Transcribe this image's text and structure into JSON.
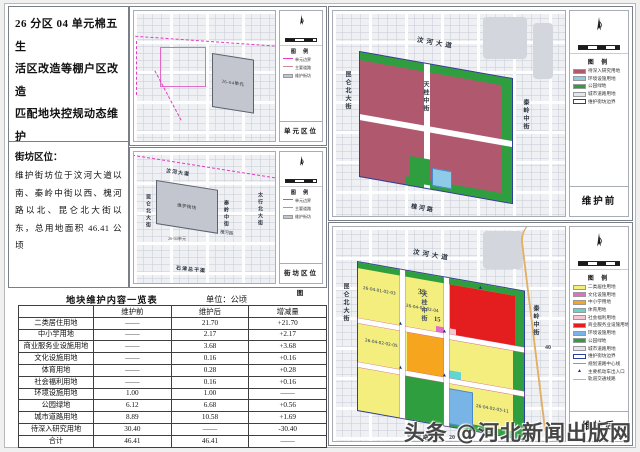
{
  "title_lines": [
    "26 分区 04 单元棉五生",
    "活区改造等棚户区改造",
    "匹配地块控规动态维护",
    "方案"
  ],
  "location": {
    "heading": "街坊区位：",
    "body": "维护街坊位于汶河大道以南、秦岭中街以西、槐河路以北、昆仑北大街以东，总用地面积 46.41 公顷"
  },
  "colors": {
    "residential": "#f3ee7e",
    "commercial": "#e41e1e",
    "school": "#f5a61e",
    "culture": "#e26cc8",
    "sports": "#62d4d4",
    "welfare": "#f5c6d6",
    "environment": "#79b4e6",
    "envlight": "#8ecbe8",
    "park": "#2f9e3f",
    "road": "#e4e6ea",
    "study": "#b0596e",
    "boundary": "#2b3f9e",
    "unitdash": "#e23cc0"
  },
  "unit_map": {
    "caption": "单元区位图",
    "legend_title": "图 例",
    "legend": [
      {
        "type": "dash",
        "color": "#e23cc0",
        "label": "单元边界"
      },
      {
        "type": "line",
        "color": "#d08890",
        "label": "主要道路"
      },
      {
        "type": "fill",
        "color": "#c3c6cf",
        "label": "维护街坊"
      }
    ],
    "block_label": "26-04单元"
  },
  "block_map": {
    "caption": "街坊区位图",
    "legend_title": "图 例",
    "legend": [
      {
        "type": "dash",
        "color": "#e23cc0",
        "label": "单元边界"
      },
      {
        "type": "line",
        "color": "#d08890",
        "label": "主要道路"
      },
      {
        "type": "fill",
        "color": "#c3c6cf",
        "label": "维护街坊"
      }
    ],
    "block_label": "维护街坊",
    "unit_note": "26-04单元",
    "roads": {
      "top": "汶河大道",
      "left": "昆仑北大街",
      "center": "秦岭中街",
      "right": "太行北大街",
      "bottom": "石津总干渠",
      "near": "槐河路"
    }
  },
  "before_map": {
    "caption": "维护前",
    "legend_title": "图 例",
    "legend": [
      {
        "type": "fill",
        "color": "#b0596e",
        "label": "待深入研究用地"
      },
      {
        "type": "fill",
        "color": "#8ecbe8",
        "label": "环境设施用地"
      },
      {
        "type": "fill",
        "color": "#2f9e3f",
        "label": "公园绿地"
      },
      {
        "type": "fill",
        "color": "#e4e6ea",
        "label": "城市道路用地"
      },
      {
        "type": "outline",
        "color": "#2b3f9e",
        "label": "维护街坊边界"
      }
    ],
    "roads": {
      "top": "汶河大道",
      "left": "昆仑北大街",
      "center": "天桂中街",
      "right": "秦岭中街",
      "bottom": "槐河路"
    }
  },
  "after_map": {
    "caption": "维护后",
    "legend_title": "图 例",
    "legend": [
      {
        "type": "fill",
        "color": "#f3ee7e",
        "label": "二类居住用地"
      },
      {
        "type": "fill",
        "color": "#e26cc8",
        "label": "文化设施用地"
      },
      {
        "type": "fill",
        "color": "#f5a61e",
        "label": "中小学用地"
      },
      {
        "type": "fill",
        "color": "#62d4d4",
        "label": "体育用地"
      },
      {
        "type": "fill",
        "color": "#f5c6d6",
        "label": "社会福利用地"
      },
      {
        "type": "fill",
        "color": "#e41e1e",
        "label": "商业服务业设施用地"
      },
      {
        "type": "fill",
        "color": "#79b4e6",
        "label": "环境设施用地"
      },
      {
        "type": "fill",
        "color": "#2f9e3f",
        "label": "公园绿地"
      },
      {
        "type": "fill",
        "color": "#e4e6ea",
        "label": "城市道路用地"
      },
      {
        "type": "outline",
        "color": "#2b3f9e",
        "label": "维护街坊边界"
      },
      {
        "type": "dash",
        "color": "#e86ca0",
        "label": "规划道路中心线"
      },
      {
        "type": "tri",
        "color": "#15308a",
        "label": "主要机动车出入口"
      },
      {
        "type": "line",
        "color": "#e3b063",
        "label": "轨道交通线路"
      }
    ],
    "roads": {
      "top": "汶河大道",
      "left": "昆仑北大街",
      "center": "天桂中街",
      "right": "秦岭中街",
      "bottom": "槐河路"
    },
    "codes": [
      "26-04-01-02-03",
      "26-04-01-02-04",
      "26-04-02-02-05",
      "26-04-02-03-11"
    ],
    "marks": [
      "35",
      "15",
      "40",
      "20"
    ]
  },
  "table": {
    "title": "地块维护内容一览表",
    "unit": "单位：公顷",
    "headers": [
      "",
      "维护前",
      "维护后",
      "增减量"
    ],
    "rows": [
      [
        "二类居住用地",
        "——",
        "21.70",
        "+21.70"
      ],
      [
        "中小学用地",
        "——",
        "2.17",
        "+2.17"
      ],
      [
        "商业服务业设施用地",
        "——",
        "3.68",
        "+3.68"
      ],
      [
        "文化设施用地",
        "——",
        "0.16",
        "+0.16"
      ],
      [
        "体育用地",
        "——",
        "0.28",
        "+0.28"
      ],
      [
        "社会福利用地",
        "——",
        "0.16",
        "+0.16"
      ],
      [
        "环境设施用地",
        "1.00",
        "1.00",
        "——"
      ],
      [
        "公园绿地",
        "6.12",
        "6.68",
        "+0.56"
      ],
      [
        "城市道路用地",
        "8.89",
        "10.58",
        "+1.69"
      ],
      [
        "待深入研究用地",
        "30.40",
        "——",
        "-30.40"
      ],
      [
        "合计",
        "46.41",
        "46.41",
        "——"
      ]
    ]
  },
  "watermark": "头条 @河北新闻出版网"
}
